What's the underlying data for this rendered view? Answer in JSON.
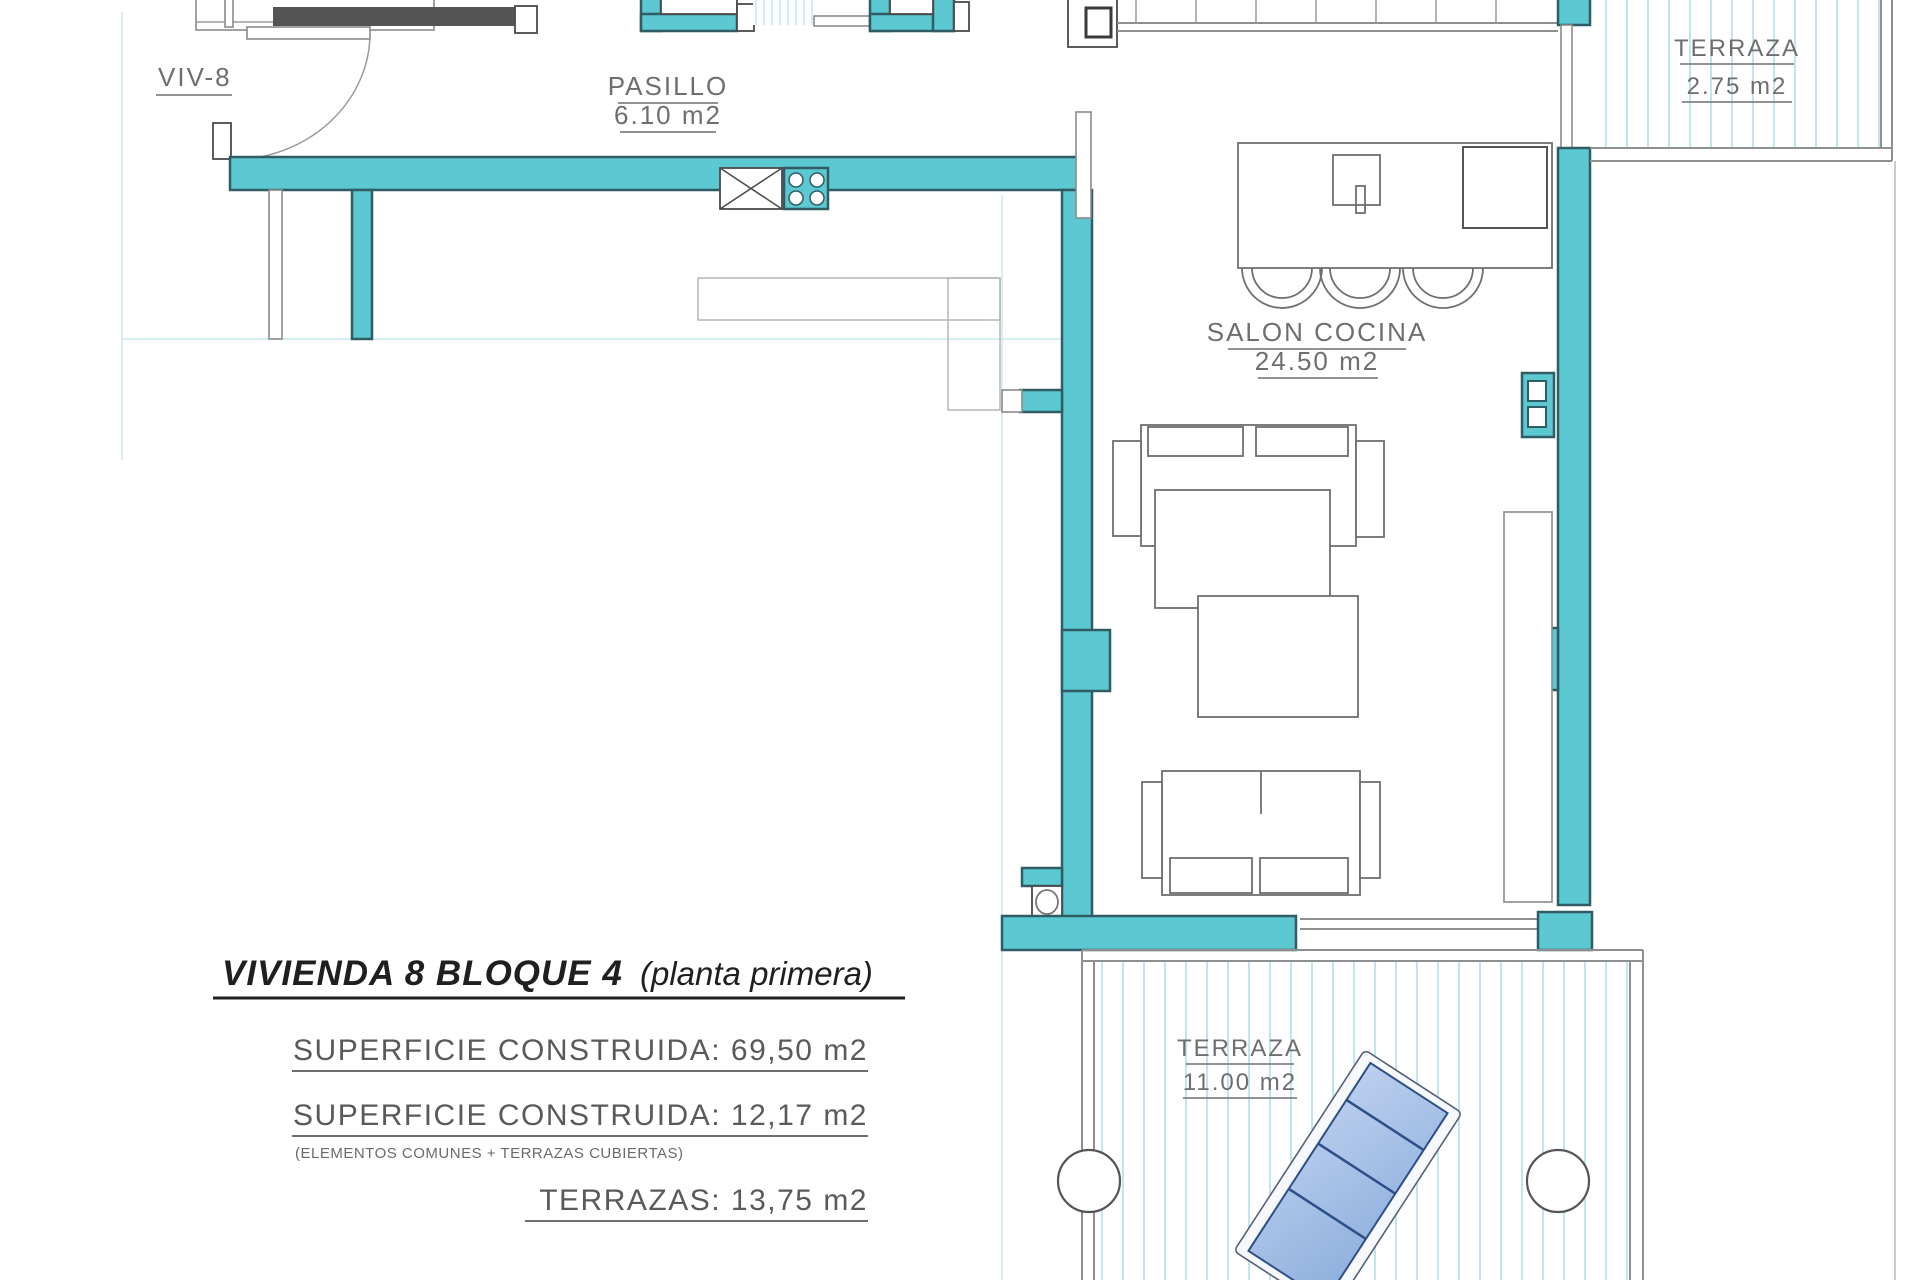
{
  "plan_title": {
    "main": "VIVIENDA 8 BLOQUE 4",
    "suffix": "(planta primera)"
  },
  "unit": {
    "label": "VIV-8"
  },
  "rooms": {
    "pasillo": {
      "name": "PASILLO",
      "area": "6.10 m2"
    },
    "salon": {
      "name": "SALON COCINA",
      "area": "24.50 m2"
    },
    "terraza_top": {
      "name": "TERRAZA",
      "area": "2.75 m2"
    },
    "terraza_bottom": {
      "name": "TERRAZA",
      "area": "11.00 m2"
    }
  },
  "measurements": {
    "line1": "SUPERFICIE CONSTRUIDA: 69,50 m2",
    "line2": "SUPERFICIE CONSTRUIDA: 12,17 m2",
    "line2_note": "(ELEMENTOS COMUNES + TERRAZAS CUBIERTAS)",
    "line3": "TERRAZAS: 13,75 m2"
  },
  "colors": {
    "wall_fill": "#5BC8D2",
    "wall_outline": "#2F5D63",
    "hatch_line": "#BFE6EE",
    "furniture_line": "#6F6F6F",
    "label_text": "#6E6E6E",
    "title_text": "#1F1F1F",
    "lounger_fill": "#A3BDE6",
    "lounger_line": "#2B4F86"
  }
}
